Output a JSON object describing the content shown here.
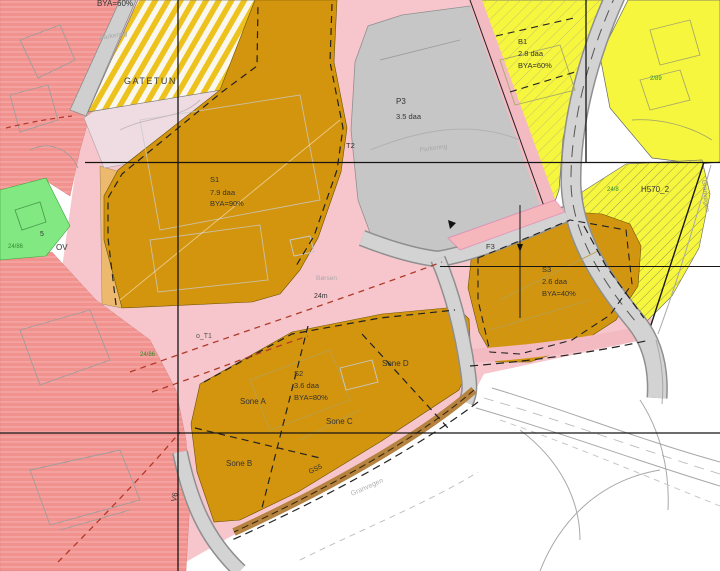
{
  "zones": {
    "s1": {
      "code": "S1",
      "area": "7.9 daa",
      "bya": "BYA=90%"
    },
    "s2": {
      "code": "S2",
      "area": "3.6 daa",
      "bya": "BYA=80%"
    },
    "s3": {
      "code": "S3",
      "area": "2.6 daa",
      "bya": "BYA=40%"
    },
    "b1": {
      "code": "B1",
      "area": "2.8 daa",
      "bya": "BYA=60%"
    },
    "p3": {
      "code": "P3",
      "area": "3.5 daa"
    },
    "h570": {
      "code": "H570_2"
    },
    "gatetun": "GATETUN",
    "clipped_top_bya": "BYA=60%"
  },
  "sones": {
    "a": "Sone A",
    "b": "Sone B",
    "c": "Sone C",
    "d": "Sone D"
  },
  "road_labels": {
    "t2": "T2",
    "f3": "F3",
    "ov": "OV",
    "v6": "V6",
    "t1": "o_T1",
    "gs": "GS5",
    "marker_5": "5"
  },
  "annotations": {
    "parkering": "Parkering",
    "borsen": "Børsen",
    "width_24m": "24m",
    "street": "Granvegen"
  },
  "parcels": {
    "p1": "24/86",
    "p2": "2/89",
    "p3": "24/8",
    "p4": "24/86"
  },
  "colors": {
    "zone_orange": "#d3950e",
    "yellow": "#f6f63e",
    "stripe_gold": "#eec21d",
    "pink": "#f6c6cc",
    "pale_pink": "#eedce2",
    "salmon": "#f2928e",
    "gray_parking": "#c6c6c6",
    "road_gray": "#d3d3d3",
    "tan": "#ecb96e",
    "brown_strip": "#b5823f",
    "green_area": "#82e882",
    "red_dash": "#b03a2a"
  }
}
